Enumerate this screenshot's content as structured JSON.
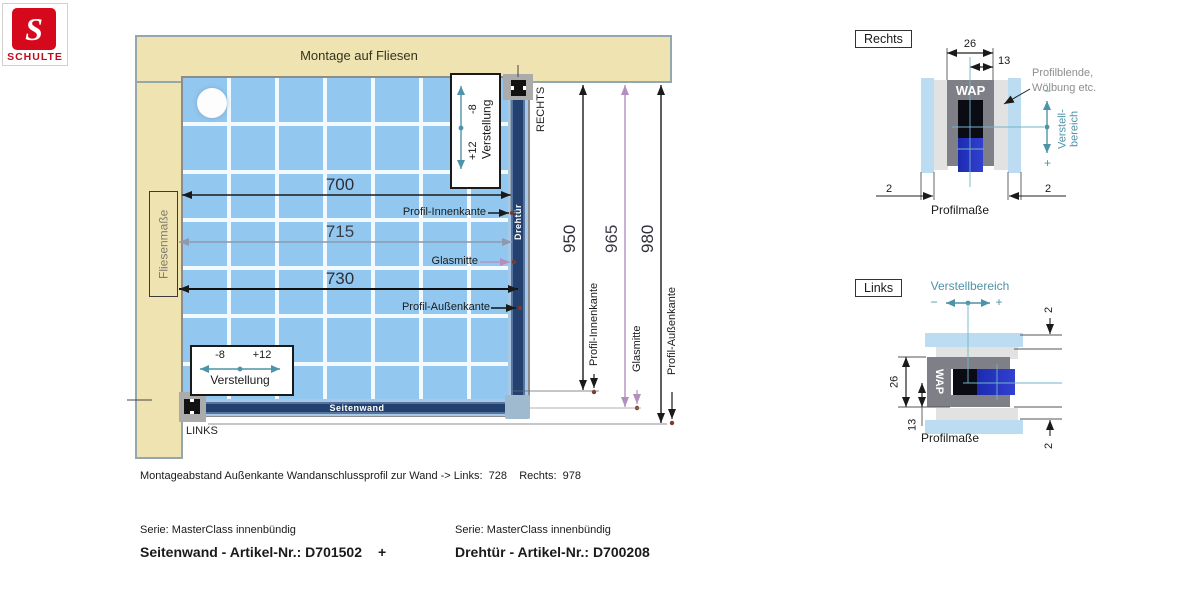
{
  "logo": {
    "letter": "S",
    "brand": "SCHULTE"
  },
  "diagram": {
    "title": "Montage auf Fliesen",
    "fliesenmasse": "Fliesenmaße",
    "rechts": "RECHTS",
    "links": "LINKS",
    "seitenwand": "Seitenwand",
    "drehtuer": "Drehtür",
    "dim_700": "700",
    "dim_715": "715",
    "dim_730": "730",
    "dim_950": "950",
    "dim_965": "965",
    "dim_980": "980",
    "profil_innenkante": "Profil-Innenkante",
    "glasmitte": "Glasmitte",
    "profil_aussenkante": "Profil-Außenkante",
    "verstellung": "Verstellung",
    "minus_8": "-8",
    "plus_12": "+12"
  },
  "rechts_detail": {
    "title": "Rechts",
    "wap": "WAP",
    "dim_26": "26",
    "dim_13": "13",
    "dim_2_left": "2",
    "dim_2_right": "2",
    "blende_line1": "Profilblende,",
    "blende_line2": "Wölbung etc.",
    "verstell_line1": "Verstell-",
    "verstell_line2": "bereich",
    "minus": "−",
    "plus": "+",
    "caption": "Profilmaße"
  },
  "links_detail": {
    "title": "Links",
    "wap": "WAP",
    "verstellbereich": "Verstellbereich",
    "minus": "−",
    "plus": "+",
    "dim_26": "26",
    "dim_13": "13",
    "dim_2_top": "2",
    "dim_2_bottom": "2",
    "caption": "Profilmaße"
  },
  "footer": {
    "montage_note": "Montageabstand Außenkante Wandanschlussprofil zur Wand -> Links:  728    Rechts:  978",
    "serie_left": "Serie: MasterClass innenbündig",
    "artikel_left": "Seitenwand - Artikel-Nr.: D701502",
    "plus": "+",
    "serie_right": "Serie: MasterClass innenbündig",
    "artikel_right": "Drehtür - Artikel-Nr.: D700208"
  },
  "colors": {
    "logo_red": "#d6081c",
    "tile_blue": "#92c8ef",
    "beige": "#efe3b2",
    "profile_blue": "#24406e",
    "accent_teal": "#4e93a8",
    "dim_lilac": "#b48fbe",
    "glass_blue": "#2834c8"
  }
}
